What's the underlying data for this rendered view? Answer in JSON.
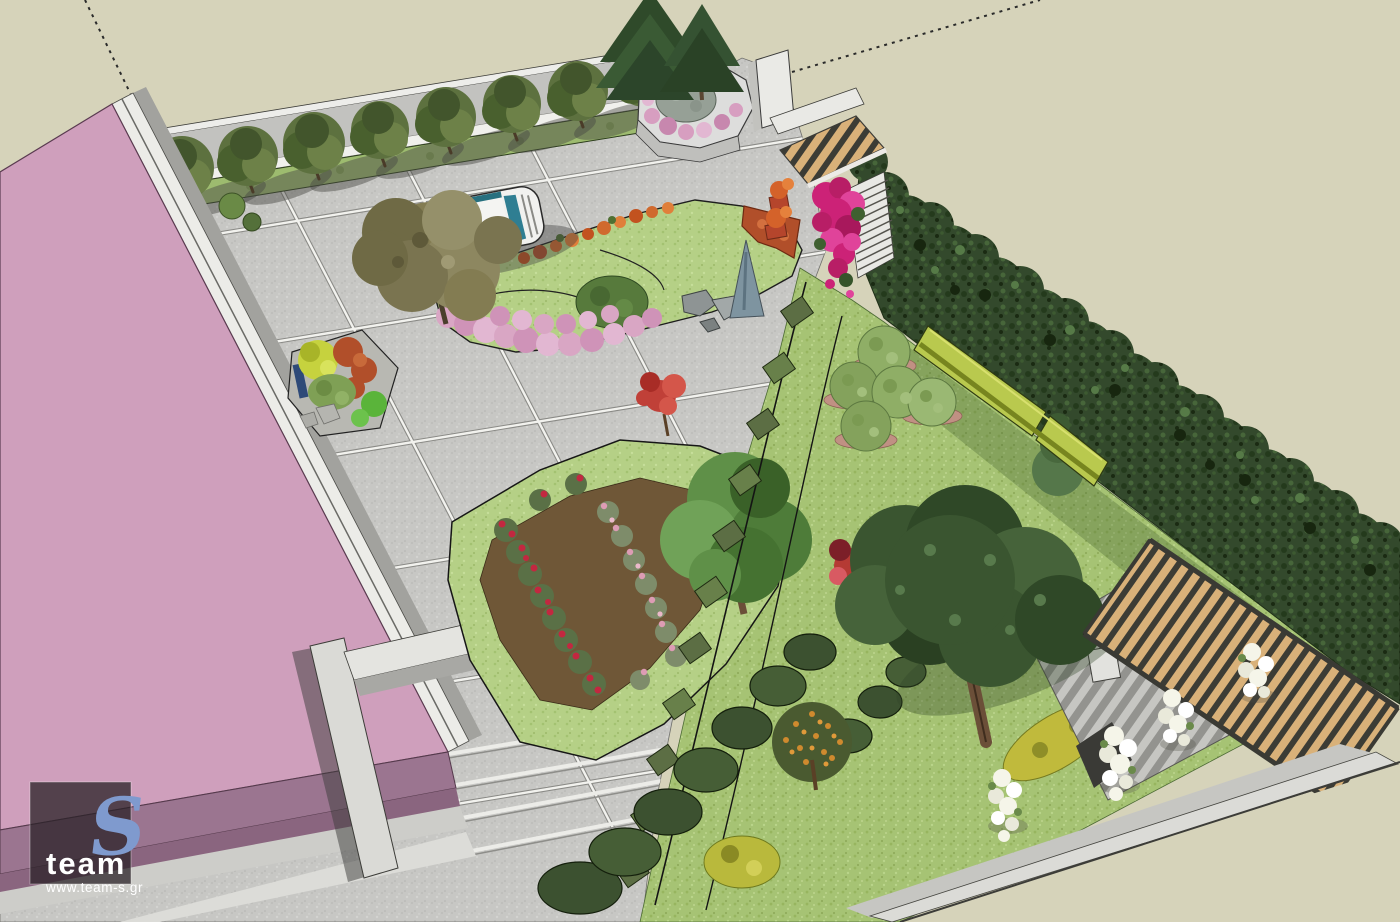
{
  "scene": {
    "type": "3d-landscape-render",
    "description": "Aerial axonometric SketchUp-style render of a residential garden design: pink-roofed building, paved courtyard with joint grid, street-tree row along boundary wall, parked car under olive tree, flower beds (orange/pink carpet, rose bed), large lawn with topiary balls, tall cypress hedge, entrance pergola with bougainvillea, timber-slat pergola deck and perimeter wall with white flowering shrubs",
    "watermark": {
      "mark": "S",
      "name": "team",
      "website": "www.team-s.gr"
    }
  },
  "colors": {
    "canvas_bg": "#d6d3ba",
    "paving": "#c7c7c4",
    "joint_white": "#f2f2ee",
    "sidewalk": "#cdcdc9",
    "curb_white": "#f0f0ec",
    "wall_light": "#ededea",
    "wall_face": "#c2c2bf",
    "building_roof": "#cf9fbc",
    "building_front": "#9b7590",
    "building_front_dark": "#8a657f",
    "boundary_wall_white": "#ecece8",
    "boundary_wall_shadow": "#a2a29e",
    "pillar": "#dadad6",
    "lawn": "#a6c374",
    "lawn_light": "#b5d086",
    "hedge_dark": "#33492c",
    "boxwood": "#b9c94e",
    "street_tree": "#5d713f",
    "conifer": "#2f4a2a",
    "olive": "#837c52",
    "pine": "#3a5530",
    "tree_green": "#5f9048",
    "mulch": "#6f5737",
    "mulch_ring": "#c09083",
    "rose_red": "#c22840",
    "rose_pink": "#dd9cb4",
    "pink_carpet": "#d9a6c4",
    "rust": "#b14f2a",
    "orange_flower": "#d06a2e",
    "autumn_orange": "#cf8a2e",
    "yellow_bush": "#c0ba3c",
    "bougainvillea": "#cc2277",
    "wood": "#d9b179",
    "slat_gap": "#3c3c35",
    "deck_light": "#c6c6c2",
    "deck_dark": "#93938f",
    "car_body": "#f1f1ef",
    "car_glass": "#2f7e92",
    "white_flower": "#f5f5e9",
    "blue_conifer": "#7e94a0",
    "terracotta": "#b5452c",
    "dotted_line": "#2a2a2a",
    "logo_bg": "rgba(42,33,39,0.75)",
    "logo_blue": "#7f9ace",
    "logo_text": "#ffffff"
  }
}
